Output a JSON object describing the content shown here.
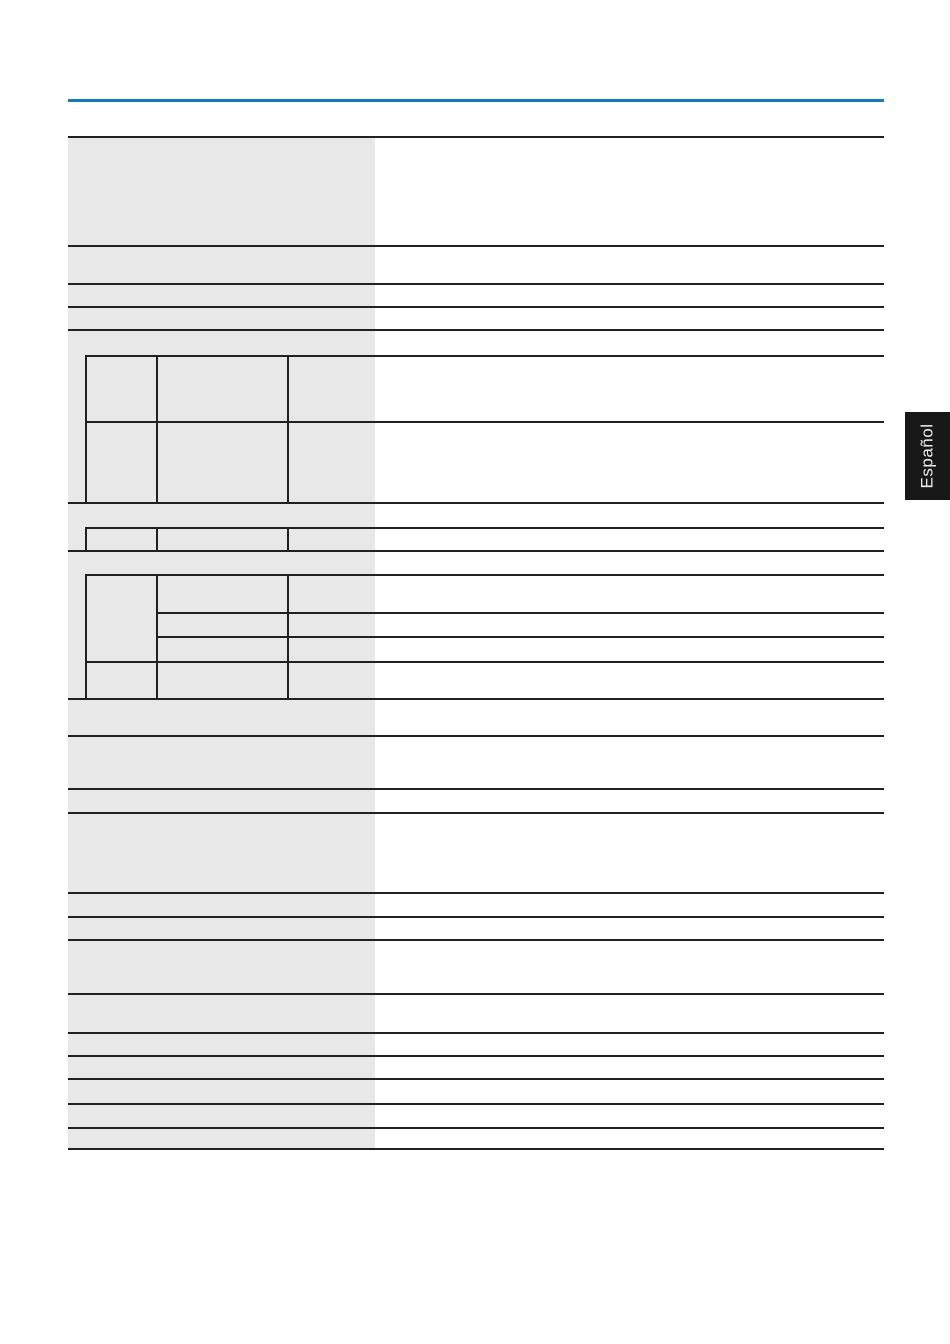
{
  "language_tab": {
    "label": "Español"
  },
  "colors": {
    "accent_rule_blue": "#1a78be",
    "table_line": "#212121",
    "label_column_bg": "#e8e8e8",
    "tab_bg": "#181818",
    "tab_text": "#ededed",
    "page_bg": "#ffffff"
  },
  "spec_table": {
    "visible_text": [],
    "note": "all table cells are empty in the rendered pixels"
  }
}
